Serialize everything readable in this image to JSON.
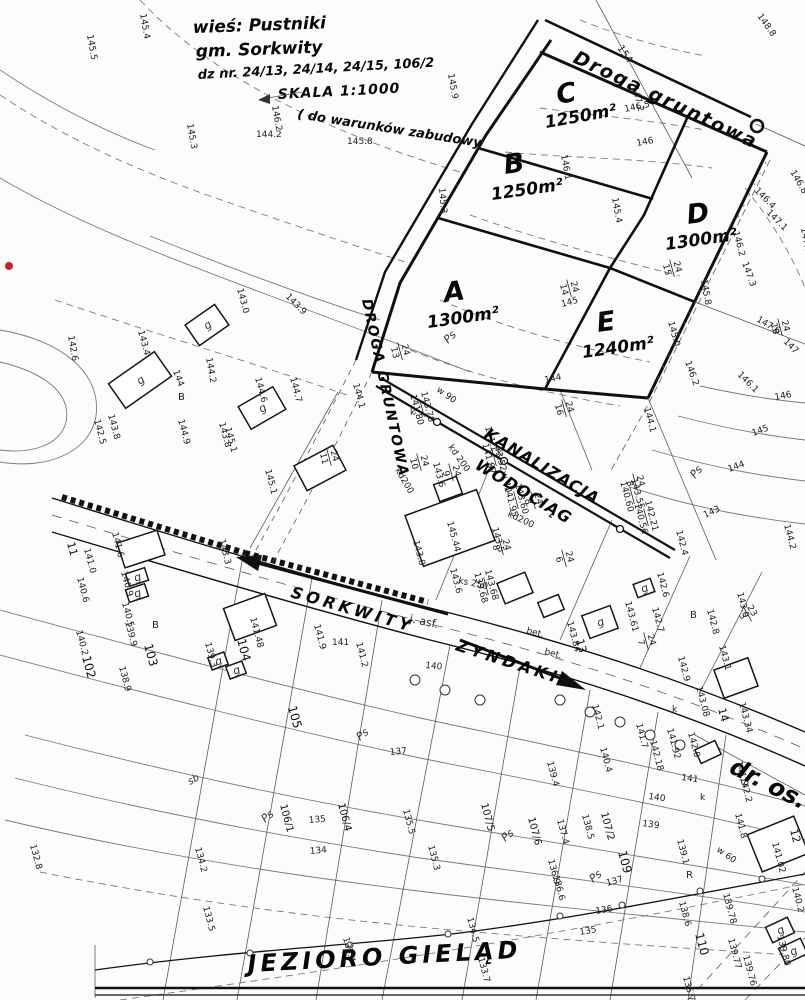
{
  "header": {
    "village": "wieś: Pustniki",
    "commune": "gm.  Sorkwity",
    "parcels": "dz nr. 24/13, 24/14, 24/15, 106/2",
    "scale": "SKALA 1:1000",
    "note": "( do warunków zabudowy"
  },
  "roads": {
    "top_road": "Droga gruntowa",
    "left_road": "DROGA GRUNTOWA",
    "sewer": "KANALIZACJA",
    "water": "WODOCIĄG",
    "dir_west": "SORKWITY",
    "dir_east": "ZYNDAKI",
    "street_br": "dr. os.",
    "lake": "JEZIORO GIELĄD",
    "surface_asphalt": "j. asf.",
    "surface_concrete": "bet."
  },
  "plots": [
    {
      "letter": "A",
      "area": "1300m²",
      "lx": 445,
      "ly": 302,
      "ax": 428,
      "ay": 328,
      "r": -8
    },
    {
      "letter": "B",
      "area": "1250m²",
      "lx": 505,
      "ly": 174,
      "ax": 492,
      "ay": 200,
      "r": -8
    },
    {
      "letter": "C",
      "area": "1250m²",
      "lx": 558,
      "ly": 104,
      "ax": 546,
      "ay": 128,
      "r": -10
    },
    {
      "letter": "D",
      "area": "1300m²",
      "lx": 688,
      "ly": 224,
      "ax": 666,
      "ay": 250,
      "r": -8
    },
    {
      "letter": "E",
      "area": "1240m²",
      "lx": 598,
      "ly": 332,
      "ax": 583,
      "ay": 358,
      "r": -8
    }
  ],
  "labels": [
    [
      "145.5",
      87,
      35,
      80
    ],
    [
      "145.4",
      140,
      14,
      80
    ],
    [
      "148.8",
      757,
      16,
      55
    ],
    [
      "154",
      617,
      48,
      55,
      10
    ],
    [
      "147.2",
      632,
      87,
      75
    ],
    [
      "145.9",
      448,
      74,
      80
    ],
    [
      "146.2",
      272,
      106,
      80
    ],
    [
      "145.3",
      187,
      124,
      80
    ],
    [
      "145.8",
      347,
      144,
      0
    ],
    [
      "144.2",
      256,
      137,
      0
    ],
    [
      "146.5",
      625,
      112,
      -12
    ],
    [
      "146",
      637,
      146,
      -10
    ],
    [
      "146.1",
      561,
      155,
      80
    ],
    [
      "145.3",
      439,
      188,
      85
    ],
    [
      "145.4",
      612,
      198,
      80
    ],
    [
      "146.2",
      733,
      232,
      75
    ],
    [
      "146.4",
      754,
      191,
      45
    ],
    [
      "147.1",
      766,
      213,
      45
    ],
    [
      "146.8",
      790,
      172,
      60
    ],
    [
      "147.0",
      801,
      228,
      80
    ],
    [
      "145.8",
      701,
      280,
      80
    ],
    [
      "147.3",
      742,
      263,
      70
    ],
    [
      "147.6",
      756,
      321,
      30
    ],
    [
      "147",
      783,
      342,
      45
    ],
    [
      "146.1",
      737,
      375,
      45
    ],
    [
      "146.2",
      685,
      362,
      70
    ],
    [
      "145.0",
      668,
      322,
      75
    ],
    [
      "145",
      562,
      307,
      -15
    ],
    [
      "144",
      545,
      383,
      -12
    ],
    [
      "144.1",
      644,
      408,
      75
    ],
    [
      "143",
      705,
      518,
      -25
    ],
    [
      "144",
      729,
      472,
      -20
    ],
    [
      "145",
      753,
      436,
      -20
    ],
    [
      "146",
      775,
      400,
      -10
    ],
    [
      "144.2",
      784,
      525,
      75
    ],
    [
      "142.4",
      676,
      531,
      75
    ],
    [
      "Ps",
      695,
      479,
      -50,
      11,
      "soil"
    ],
    [
      "Ps",
      448,
      344,
      -45,
      11,
      "soil"
    ],
    [
      "142.6",
      68,
      336,
      80
    ],
    [
      "143.0",
      237,
      289,
      75
    ],
    [
      "143.4",
      138,
      331,
      75
    ],
    [
      "144",
      173,
      371,
      70
    ],
    [
      "144.2",
      206,
      358,
      80
    ],
    [
      "143.9",
      285,
      297,
      45
    ],
    [
      "143.8",
      108,
      415,
      75
    ],
    [
      "143.8",
      219,
      423,
      75
    ],
    [
      "142.5",
      94,
      420,
      75
    ],
    [
      "144.9",
      178,
      420,
      75
    ],
    [
      "144.6",
      255,
      378,
      75
    ],
    [
      "144.7",
      290,
      378,
      75
    ],
    [
      "145.1",
      225,
      428,
      75
    ],
    [
      "145.1",
      265,
      470,
      75
    ],
    [
      "144.1",
      353,
      384,
      75
    ],
    [
      "B",
      178,
      400,
      0,
      10
    ],
    [
      "B",
      152,
      628,
      0,
      10
    ],
    [
      "141.0",
      84,
      549,
      75
    ],
    [
      "11",
      67,
      543,
      75,
      11,
      "pn"
    ],
    [
      "140.6",
      77,
      578,
      75
    ],
    [
      "140.2",
      76,
      631,
      75
    ],
    [
      "141.6",
      112,
      533,
      75
    ],
    [
      "140.9",
      121,
      572,
      75
    ],
    [
      "140.5",
      122,
      603,
      75
    ],
    [
      "139.9",
      125,
      622,
      75
    ],
    [
      "138.9",
      119,
      667,
      75
    ],
    [
      "139.3",
      205,
      643,
      75
    ],
    [
      "103",
      144,
      645,
      75,
      12,
      "pn"
    ],
    [
      "102",
      82,
      657,
      75,
      12,
      "pn"
    ],
    [
      "104",
      237,
      640,
      75,
      12,
      "pn"
    ],
    [
      "141.48",
      250,
      618,
      75
    ],
    [
      "143.3",
      219,
      540,
      75
    ],
    [
      "105",
      288,
      707,
      75,
      12,
      "pn"
    ],
    [
      "sb",
      190,
      785,
      -30,
      10,
      "soil"
    ],
    [
      "Ps",
      360,
      741,
      -40,
      11,
      "soil"
    ],
    [
      "Ps",
      265,
      823,
      -40,
      11,
      "soil"
    ],
    [
      "132.8",
      30,
      845,
      75
    ],
    [
      "134.2",
      195,
      848,
      75
    ],
    [
      "133.5",
      203,
      907,
      75
    ],
    [
      "w 90",
      436,
      391,
      35
    ],
    [
      "k",
      410,
      415,
      0
    ],
    [
      "143.6",
      433,
      463,
      75
    ],
    [
      "kd200",
      395,
      470,
      60
    ],
    [
      "kd 200",
      448,
      447,
      55
    ],
    [
      "141.1",
      485,
      427,
      75
    ],
    [
      "w 40",
      501,
      472,
      75
    ],
    [
      "k",
      497,
      455,
      0
    ],
    [
      "kd200",
      507,
      516,
      25
    ],
    [
      "143.5",
      492,
      528,
      75
    ],
    [
      "143.8",
      413,
      541,
      75
    ],
    [
      "145.44",
      447,
      522,
      75
    ],
    [
      "143.6",
      450,
      569,
      75
    ],
    [
      "ks 250",
      458,
      583,
      12
    ],
    [
      "141.9",
      314,
      625,
      75
    ],
    [
      "141",
      332,
      645,
      0
    ],
    [
      "141.2",
      356,
      643,
      75
    ],
    [
      "140",
      425,
      668,
      5
    ],
    [
      "143.84",
      567,
      622,
      75
    ],
    [
      "13",
      576,
      640,
      75,
      11,
      "pn"
    ],
    [
      "142.6",
      657,
      573,
      75
    ],
    [
      "143.61",
      625,
      602,
      75
    ],
    [
      "142.7",
      652,
      608,
      75
    ],
    [
      "142.8",
      707,
      610,
      75
    ],
    [
      "143.0",
      737,
      593,
      75
    ],
    [
      "B",
      690,
      618,
      0,
      10
    ],
    [
      "143.1",
      719,
      646,
      75
    ],
    [
      "142.9",
      678,
      657,
      75
    ],
    [
      "143.08",
      696,
      687,
      75
    ],
    [
      "14",
      718,
      709,
      75,
      11,
      "pn"
    ],
    [
      "143.34",
      739,
      703,
      75
    ],
    [
      "142.1",
      592,
      705,
      75
    ],
    [
      "141.7",
      636,
      724,
      75
    ],
    [
      "141.92",
      667,
      729,
      75
    ],
    [
      "142.0",
      688,
      733,
      75
    ],
    [
      "140.4",
      600,
      748,
      75
    ],
    [
      "142.18",
      650,
      741,
      75
    ],
    [
      "141",
      681,
      780,
      8
    ],
    [
      "140",
      648,
      799,
      8
    ],
    [
      "139",
      642,
      826,
      8
    ],
    [
      "141.9",
      736,
      762,
      75
    ],
    [
      "142.2",
      740,
      778,
      75
    ],
    [
      "141.8",
      735,
      814,
      75
    ],
    [
      "w 60",
      716,
      851,
      35
    ],
    [
      "k",
      672,
      712,
      0
    ],
    [
      "k",
      700,
      800,
      0
    ],
    [
      "137",
      390,
      755,
      -5
    ],
    [
      "135",
      309,
      823,
      -5
    ],
    [
      "134",
      310,
      854,
      -5
    ],
    [
      "135.5",
      403,
      810,
      75
    ],
    [
      "135.3",
      428,
      846,
      75
    ],
    [
      "134.5",
      467,
      918,
      75
    ],
    [
      "135",
      580,
      935,
      -10
    ],
    [
      "136",
      596,
      914,
      -10
    ],
    [
      "137",
      607,
      886,
      -15
    ],
    [
      "139.4",
      547,
      762,
      75
    ],
    [
      "138.5",
      582,
      815,
      75
    ],
    [
      "137.4",
      557,
      820,
      75
    ],
    [
      "136.9",
      548,
      860,
      75
    ],
    [
      "136.6",
      553,
      876,
      75
    ],
    [
      "133.4",
      343,
      938,
      75
    ],
    [
      "133.7",
      478,
      958,
      75
    ],
    [
      "106/1",
      280,
      805,
      75,
      10,
      "pn"
    ],
    [
      "106/4",
      338,
      804,
      75,
      10,
      "pn"
    ],
    [
      "107/5",
      481,
      804,
      75,
      10,
      "pn"
    ],
    [
      "107/6",
      528,
      818,
      75,
      10,
      "pn"
    ],
    [
      "107/2",
      601,
      813,
      75,
      10,
      "pn"
    ],
    [
      "109",
      618,
      852,
      75,
      12,
      "pn"
    ],
    [
      "110",
      695,
      934,
      75,
      12,
      "pn"
    ],
    [
      "Ps",
      505,
      842,
      -40,
      11,
      "soil"
    ],
    [
      "Ps",
      593,
      883,
      -40,
      11,
      "soil"
    ],
    [
      "139.1",
      677,
      840,
      75
    ],
    [
      "138.6",
      679,
      902,
      75
    ],
    [
      "R",
      686,
      878,
      0,
      10
    ],
    [
      "135.7",
      683,
      977,
      75
    ],
    [
      "139.78",
      723,
      894,
      75
    ],
    [
      "139.77",
      728,
      939,
      75
    ],
    [
      "139.76",
      743,
      956,
      75
    ],
    [
      "139.80",
      777,
      936,
      75
    ],
    [
      "140.2",
      792,
      888,
      75
    ],
    [
      "141.02",
      772,
      843,
      75
    ],
    [
      "12",
      790,
      830,
      75,
      11,
      "pn"
    ]
  ],
  "fractions": [
    [
      "24",
      "14",
      570,
      288,
      75
    ],
    [
      "24",
      "15",
      673,
      268,
      75
    ],
    [
      "24",
      "16",
      565,
      408,
      75
    ],
    [
      "24",
      "18",
      781,
      327,
      75
    ],
    [
      "24",
      "13",
      401,
      351,
      75
    ],
    [
      "24",
      "11",
      330,
      457,
      75
    ],
    [
      "24",
      "10",
      420,
      462,
      75
    ],
    [
      "24",
      "9",
      452,
      472,
      75
    ],
    [
      "24",
      "8",
      534,
      500,
      75
    ],
    [
      "24",
      "8",
      636,
      482,
      75
    ],
    [
      "24",
      "8",
      502,
      546,
      75
    ],
    [
      "24",
      "7",
      647,
      641,
      75
    ],
    [
      "24",
      "6",
      565,
      558,
      75
    ],
    [
      "23",
      "3",
      748,
      613,
      60
    ],
    [
      "143.70",
      "141.80",
      423,
      408,
      75
    ],
    [
      "143.52",
      "141.87",
      495,
      457,
      75
    ],
    [
      "143.60",
      "141.95",
      517,
      500,
      75
    ],
    [
      "142.21",
      "140.56",
      647,
      517,
      75
    ],
    [
      "143.68",
      "139.68",
      487,
      586,
      75
    ],
    [
      "143.55",
      "140.60",
      633,
      495,
      75
    ]
  ],
  "buildings": [
    [
      207,
      325,
      36,
      25,
      -35,
      "g"
    ],
    [
      140,
      380,
      56,
      30,
      -35,
      "g"
    ],
    [
      262,
      408,
      40,
      26,
      -30,
      "g"
    ],
    [
      320,
      468,
      44,
      28,
      -28,
      ""
    ],
    [
      141,
      549,
      42,
      26,
      -18,
      ""
    ],
    [
      137,
      577,
      20,
      13,
      -18,
      "g"
    ],
    [
      137,
      593,
      20,
      13,
      -18,
      "g"
    ],
    [
      250,
      617,
      44,
      34,
      -20,
      ""
    ],
    [
      218,
      661,
      17,
      13,
      -20,
      "g"
    ],
    [
      236,
      670,
      17,
      13,
      -20,
      "g"
    ],
    [
      450,
      528,
      76,
      54,
      -20,
      ""
    ],
    [
      448,
      489,
      24,
      18,
      -20,
      ""
    ],
    [
      515,
      588,
      30,
      22,
      -22,
      ""
    ],
    [
      551,
      606,
      22,
      16,
      -22,
      ""
    ],
    [
      600,
      622,
      30,
      24,
      -20,
      "g"
    ],
    [
      644,
      588,
      18,
      14,
      -20,
      "g"
    ],
    [
      736,
      678,
      36,
      30,
      -20,
      ""
    ],
    [
      708,
      752,
      22,
      15,
      -25,
      ""
    ],
    [
      778,
      844,
      50,
      40,
      -22,
      ""
    ],
    [
      780,
      930,
      24,
      17,
      -25,
      "g"
    ],
    [
      793,
      951,
      24,
      17,
      -25,
      "g"
    ]
  ],
  "colors": {
    "ink": "#1b1b1b",
    "contour": "#7a7a7a",
    "red_dot": "#c0272d",
    "paper": "#fcfcfb"
  }
}
